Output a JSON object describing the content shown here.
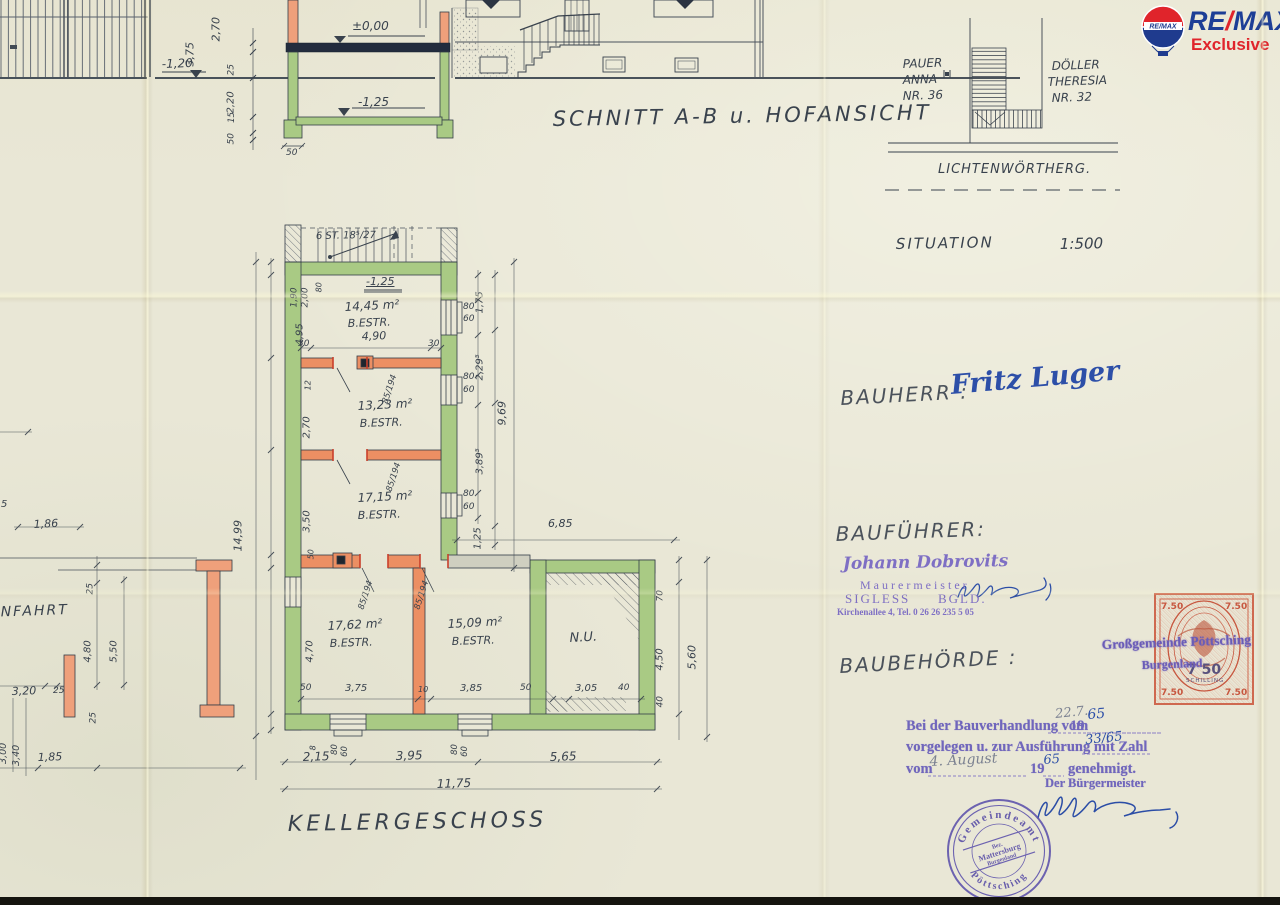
{
  "remax": {
    "re": "RE",
    "slash": "/",
    "max": "MAX",
    "sub": "Exclusive",
    "balloon_label": "RE/MAX",
    "blue": "#1d3e96",
    "red": "#e0242b"
  },
  "revenue_stamp": {
    "value": "7.50",
    "value_center": "7 50",
    "currency": "SCHILLING"
  },
  "round_stamp": {
    "top": "Gemeindeamt",
    "bottom": "Pöttsching",
    "mid1": "Bez.",
    "mid2": "Mattersburg",
    "mid3": "Burgenland"
  },
  "annotations": [
    {
      "n": "dim",
      "t": "3,75",
      "x": 196,
      "y": 55,
      "s": 11,
      "r": -90
    },
    {
      "n": "dim",
      "t": "2,70",
      "x": 222,
      "y": 30,
      "s": 11,
      "r": -90
    },
    {
      "n": "level",
      "t": "-1,20",
      "x": 162,
      "y": 58,
      "s": 12,
      "r": -2
    },
    {
      "n": "dim",
      "t": "25",
      "x": 237,
      "y": 66,
      "s": 9,
      "r": -90
    },
    {
      "n": "dim",
      "t": "2,20",
      "x": 237,
      "y": 103,
      "s": 10,
      "r": -90
    },
    {
      "n": "dim",
      "t": "15",
      "x": 237,
      "y": 114,
      "s": 8.5,
      "r": -90
    },
    {
      "n": "dim",
      "t": "50",
      "x": 237,
      "y": 135,
      "s": 9,
      "r": -90
    },
    {
      "n": "level",
      "t": "±0,00",
      "x": 352,
      "y": 20,
      "s": 12
    },
    {
      "n": "level",
      "t": "-1,25",
      "x": 358,
      "y": 96,
      "s": 12
    },
    {
      "n": "dim",
      "t": "50",
      "x": 286,
      "y": 149,
      "s": 9
    },
    {
      "n": "dim",
      "t": "85",
      "x": 1,
      "y": 70,
      "s": 8,
      "r": -90
    },
    {
      "n": "dim",
      "t": "15",
      "x": 1,
      "y": 82,
      "s": 8,
      "r": -90
    },
    {
      "n": "dim",
      "t": "2,40",
      "x": 1,
      "y": 112,
      "s": 8,
      "r": -90
    },
    {
      "n": "dim",
      "t": "25",
      "x": 1,
      "y": 138,
      "s": 8,
      "r": -90
    },
    {
      "n": "section-title",
      "t": "SCHNITT A-B u. HOFANSICHT",
      "x": 553,
      "y": 108,
      "s": 21,
      "r": -1,
      "ls": 3
    },
    {
      "n": "neighbor-name",
      "t": "PAUER",
      "x": 903,
      "y": 58,
      "s": 12,
      "r": -2
    },
    {
      "n": "neighbor-name",
      "t": "ANNA",
      "x": 903,
      "y": 74,
      "s": 12,
      "r": -2
    },
    {
      "n": "neighbor-name",
      "t": "NR. 36",
      "x": 903,
      "y": 90,
      "s": 12,
      "r": -2
    },
    {
      "n": "neighbor-name",
      "t": "DÖLLER",
      "x": 1052,
      "y": 60,
      "s": 12,
      "r": -2
    },
    {
      "n": "neighbor-name",
      "t": "THERESIA",
      "x": 1048,
      "y": 76,
      "s": 12,
      "r": -2
    },
    {
      "n": "neighbor-name",
      "t": "NR. 32",
      "x": 1052,
      "y": 92,
      "s": 12,
      "r": -2
    },
    {
      "n": "street-name",
      "t": "LICHTENWÖRTHERG.",
      "x": 938,
      "y": 163,
      "s": 13,
      "ls": 1
    },
    {
      "n": "situation-title",
      "t": "SITUATION",
      "x": 896,
      "y": 237,
      "s": 15,
      "ls": 2,
      "r": -1
    },
    {
      "n": "situation-scale",
      "t": "1:500",
      "x": 1060,
      "y": 237,
      "s": 15,
      "r": -1
    },
    {
      "n": "stair-note",
      "t": "6 ST. 18⁵/27",
      "x": 316,
      "y": 232,
      "s": 10,
      "r": -1
    },
    {
      "n": "level",
      "t": "-1,25",
      "x": 366,
      "y": 276,
      "s": 11,
      "u": 1
    },
    {
      "n": "room-area",
      "t": "14,45 m²",
      "x": 345,
      "y": 301,
      "s": 12,
      "r": -3
    },
    {
      "n": "room-type",
      "t": "B.ESTR.",
      "x": 348,
      "y": 318,
      "s": 11,
      "r": -2
    },
    {
      "n": "dim",
      "t": "4,90",
      "x": 362,
      "y": 331,
      "s": 11,
      "r": -2
    },
    {
      "n": "dim",
      "t": "30",
      "x": 298,
      "y": 340,
      "s": 9
    },
    {
      "n": "dim",
      "t": "30",
      "x": 428,
      "y": 340,
      "s": 9
    },
    {
      "n": "dim",
      "t": "1,90",
      "x": 300,
      "y": 298,
      "s": 9,
      "r": -90
    },
    {
      "n": "dim",
      "t": "2,00",
      "x": 311,
      "y": 298,
      "s": 9,
      "r": -90
    },
    {
      "n": "dim",
      "t": "80",
      "x": 324,
      "y": 284,
      "s": 8,
      "r": -90
    },
    {
      "n": "dim",
      "t": "4,95",
      "x": 306,
      "y": 335,
      "s": 10,
      "r": -90
    },
    {
      "n": "dim",
      "t": "12",
      "x": 313,
      "y": 382,
      "s": 8,
      "r": -90
    },
    {
      "n": "dim",
      "t": "2,70",
      "x": 313,
      "y": 428,
      "s": 10,
      "r": -90
    },
    {
      "n": "dim",
      "t": "3,50",
      "x": 313,
      "y": 522,
      "s": 10,
      "r": -90
    },
    {
      "n": "dim",
      "t": "50",
      "x": 316,
      "y": 551,
      "s": 8,
      "r": -90
    },
    {
      "n": "dim",
      "t": "4,70",
      "x": 316,
      "y": 652,
      "s": 10,
      "r": -90
    },
    {
      "n": "room-area",
      "t": "13,23 m²",
      "x": 358,
      "y": 400,
      "s": 12,
      "r": -3
    },
    {
      "n": "room-type",
      "t": "B.ESTR.",
      "x": 360,
      "y": 418,
      "s": 11,
      "r": -2
    },
    {
      "n": "room-area",
      "t": "17,15 m²",
      "x": 358,
      "y": 492,
      "s": 12,
      "r": -3
    },
    {
      "n": "room-type",
      "t": "B.ESTR.",
      "x": 358,
      "y": 510,
      "s": 11,
      "r": -2
    },
    {
      "n": "room-area",
      "t": "17,62 m²",
      "x": 328,
      "y": 620,
      "s": 12,
      "r": -3
    },
    {
      "n": "room-type",
      "t": "B.ESTR.",
      "x": 330,
      "y": 638,
      "s": 11,
      "r": -2
    },
    {
      "n": "room-area",
      "t": "15,09 m²",
      "x": 448,
      "y": 618,
      "s": 12,
      "r": -3
    },
    {
      "n": "room-type",
      "t": "B.ESTR.",
      "x": 452,
      "y": 636,
      "s": 11,
      "r": -2
    },
    {
      "n": "room-name",
      "t": "N.U.",
      "x": 570,
      "y": 632,
      "s": 13,
      "r": -3
    },
    {
      "n": "door-dim",
      "t": "85/194",
      "x": 390,
      "y": 396,
      "s": 8.5,
      "r": -72
    },
    {
      "n": "door-dim",
      "t": "85/194",
      "x": 394,
      "y": 484,
      "s": 8.5,
      "r": -72
    },
    {
      "n": "door-dim",
      "t": "85/194",
      "x": 366,
      "y": 602,
      "s": 8.5,
      "r": -72
    },
    {
      "n": "door-dim",
      "t": "85/194",
      "x": 422,
      "y": 602,
      "s": 8.5,
      "r": -72
    },
    {
      "n": "window-dim",
      "t": "80",
      "x": 463,
      "y": 303,
      "s": 9
    },
    {
      "n": "window-dim",
      "t": "60",
      "x": 463,
      "y": 315,
      "s": 9
    },
    {
      "n": "window-dim",
      "t": "80",
      "x": 463,
      "y": 373,
      "s": 9
    },
    {
      "n": "window-dim",
      "t": "60",
      "x": 463,
      "y": 386,
      "s": 9
    },
    {
      "n": "window-dim",
      "t": "80",
      "x": 463,
      "y": 490,
      "s": 9
    },
    {
      "n": "window-dim",
      "t": "60",
      "x": 463,
      "y": 503,
      "s": 9
    },
    {
      "n": "dim",
      "t": "1,75",
      "x": 486,
      "y": 303,
      "s": 10,
      "r": -90
    },
    {
      "n": "dim",
      "t": "2,29⁵",
      "x": 486,
      "y": 370,
      "s": 10,
      "r": -90
    },
    {
      "n": "dim",
      "t": "9,69",
      "x": 508,
      "y": 414,
      "s": 11,
      "r": -90
    },
    {
      "n": "dim",
      "t": "3,89⁵",
      "x": 486,
      "y": 464,
      "s": 10,
      "r": -90
    },
    {
      "n": "dim",
      "t": "1,25",
      "x": 484,
      "y": 539,
      "s": 10,
      "r": -90
    },
    {
      "n": "dim",
      "t": "6,85",
      "x": 548,
      "y": 518,
      "s": 11
    },
    {
      "n": "dim",
      "t": "70",
      "x": 666,
      "y": 592,
      "s": 9,
      "r": -90
    },
    {
      "n": "dim",
      "t": "4,50",
      "x": 666,
      "y": 660,
      "s": 10,
      "r": -90
    },
    {
      "n": "dim",
      "t": "40",
      "x": 666,
      "y": 698,
      "s": 9,
      "r": -90
    },
    {
      "n": "dim",
      "t": "5,60",
      "x": 698,
      "y": 658,
      "s": 11,
      "r": -90
    },
    {
      "n": "dim",
      "t": "3,05",
      "x": 575,
      "y": 684,
      "s": 10
    },
    {
      "n": "dim",
      "t": "40",
      "x": 618,
      "y": 684,
      "s": 9
    },
    {
      "n": "dim",
      "t": "50",
      "x": 520,
      "y": 684,
      "s": 9
    },
    {
      "n": "dim",
      "t": "50",
      "x": 300,
      "y": 684,
      "s": 9
    },
    {
      "n": "dim",
      "t": "3,75",
      "x": 345,
      "y": 684,
      "s": 10
    },
    {
      "n": "dim",
      "t": "10",
      "x": 418,
      "y": 686,
      "s": 8
    },
    {
      "n": "dim",
      "t": "3,85",
      "x": 460,
      "y": 684,
      "s": 10
    },
    {
      "n": "dim",
      "t": "8",
      "x": 318,
      "y": 742,
      "s": 8,
      "r": -90
    },
    {
      "n": "dim",
      "t": "80",
      "x": 340,
      "y": 746,
      "s": 8.5,
      "r": -90
    },
    {
      "n": "dim",
      "t": "60",
      "x": 350,
      "y": 748,
      "s": 8.5,
      "r": -90
    },
    {
      "n": "dim",
      "t": "80",
      "x": 460,
      "y": 746,
      "s": 8.5,
      "r": -90
    },
    {
      "n": "dim",
      "t": "60",
      "x": 470,
      "y": 748,
      "s": 8.5,
      "r": -90
    },
    {
      "n": "dim",
      "t": "2,15",
      "x": 303,
      "y": 751,
      "s": 12,
      "r": -2
    },
    {
      "n": "dim",
      "t": "3,95",
      "x": 396,
      "y": 750,
      "s": 12,
      "r": -2
    },
    {
      "n": "dim",
      "t": "5,65",
      "x": 550,
      "y": 751,
      "s": 12,
      "r": -2
    },
    {
      "n": "dim",
      "t": "11,75",
      "x": 437,
      "y": 778,
      "s": 12,
      "r": -2
    },
    {
      "n": "plan-title",
      "t": "KELLERGESCHOSS",
      "x": 288,
      "y": 813,
      "s": 22,
      "ls": 4,
      "r": -1
    },
    {
      "n": "dim",
      "t": "14,99",
      "x": 244,
      "y": 540,
      "s": 11,
      "r": -90
    },
    {
      "n": "dim",
      "t": "1,86",
      "x": 34,
      "y": 519,
      "s": 11,
      "r": -3
    },
    {
      "n": "dim",
      "t": "25",
      "x": 96,
      "y": 585,
      "s": 9,
      "r": -90
    },
    {
      "n": "dim",
      "t": "4,80",
      "x": 94,
      "y": 652,
      "s": 10,
      "r": -90
    },
    {
      "n": "dim",
      "t": "5,50",
      "x": 120,
      "y": 652,
      "s": 10,
      "r": -90
    },
    {
      "n": "dim",
      "t": "3,20",
      "x": 12,
      "y": 686,
      "s": 11,
      "r": -2
    },
    {
      "n": "dim",
      "t": "25",
      "x": 53,
      "y": 687,
      "s": 9
    },
    {
      "n": "dim",
      "t": "25",
      "x": 99,
      "y": 714,
      "s": 9,
      "r": -90
    },
    {
      "n": "dim",
      "t": "3,00",
      "x": 9,
      "y": 754,
      "s": 9.5,
      "r": -90
    },
    {
      "n": "dim",
      "t": "3,40",
      "x": 22,
      "y": 756,
      "s": 9.5,
      "r": -90
    },
    {
      "n": "dim",
      "t": "1,85",
      "x": 38,
      "y": 752,
      "s": 11,
      "r": -2
    },
    {
      "n": "room-name",
      "t": "EINFAHRT",
      "x": -16,
      "y": 606,
      "s": 14,
      "ls": 2,
      "r": -2
    },
    {
      "n": "dim",
      "t": "5",
      "x": 1,
      "y": 500,
      "s": 10
    },
    {
      "n": "field-label",
      "t": "BAUHERR :",
      "x": 841,
      "y": 388,
      "s": 20,
      "ls": 2,
      "r": -3,
      "c": "pencil"
    },
    {
      "n": "bauherr-name",
      "t": "Fritz Luger",
      "x": 952,
      "y": 372,
      "s": 27,
      "r": -5,
      "c": "blue",
      "f": "hand",
      "w": "bold"
    },
    {
      "n": "field-label",
      "t": "BAUFÜHRER:",
      "x": 836,
      "y": 524,
      "s": 20,
      "ls": 2,
      "r": -2,
      "c": "pencil"
    },
    {
      "n": "stamp-line",
      "t": "Johann Dobrovits",
      "x": 843,
      "y": 556,
      "s": 17,
      "r": -1,
      "c": "stamp",
      "f": "hand",
      "w": "bold"
    },
    {
      "n": "stamp-line",
      "t": "Maurermeister",
      "x": 860,
      "y": 579,
      "s": 12,
      "ls": 3,
      "c": "stamp"
    },
    {
      "n": "stamp-line",
      "t": "SIGLESS",
      "x": 845,
      "y": 592,
      "s": 13,
      "ls": 2,
      "c": "stamp"
    },
    {
      "n": "stamp-line",
      "t": "BGLD.",
      "x": 938,
      "y": 592,
      "s": 13,
      "ls": 2,
      "c": "stamp"
    },
    {
      "n": "stamp-line",
      "t": "Kirchenallee 4,   Tel. 0 26 26 235 5 05",
      "x": 837,
      "y": 608,
      "s": 9,
      "w": "bold",
      "c": "stamp"
    },
    {
      "n": "field-label",
      "t": "BAUBEHÖRDE :",
      "x": 840,
      "y": 656,
      "s": 20,
      "ls": 2,
      "r": -3,
      "c": "pencil"
    },
    {
      "n": "overprint",
      "t": "Großgemeinde Pöttsching",
      "x": 1102,
      "y": 638,
      "s": 13.5,
      "w": "bold",
      "r": -2,
      "c": "stampB"
    },
    {
      "n": "overprint",
      "t": "Burgenland",
      "x": 1142,
      "y": 659,
      "s": 12,
      "w": "bold",
      "r": -2,
      "c": "stampB"
    },
    {
      "n": "form-line",
      "t": "Bei der Bauverhandlung vom",
      "x": 906,
      "y": 719,
      "s": 14.5,
      "w": "bold",
      "c": "form"
    },
    {
      "n": "form-line",
      "t": "19",
      "x": 1070,
      "y": 719,
      "s": 14.5,
      "w": "bold",
      "c": "form"
    },
    {
      "n": "form-line",
      "t": "vorgelegen u. zur Ausführung mit Zahl",
      "x": 906,
      "y": 740,
      "s": 14.5,
      "w": "bold",
      "c": "form"
    },
    {
      "n": "form-line",
      "t": "vom",
      "x": 906,
      "y": 762,
      "s": 14.5,
      "w": "bold",
      "c": "form"
    },
    {
      "n": "form-line",
      "t": "19",
      "x": 1030,
      "y": 762,
      "s": 14.5,
      "w": "bold",
      "c": "form"
    },
    {
      "n": "form-line",
      "t": "genehmigt.",
      "x": 1068,
      "y": 762,
      "s": 14.5,
      "w": "bold",
      "c": "form"
    },
    {
      "n": "form-line",
      "t": "Der Bürgermeister",
      "x": 1045,
      "y": 777,
      "s": 12.5,
      "w": "bold",
      "c": "form"
    },
    {
      "n": "handwriting",
      "t": "22.7.",
      "x": 1056,
      "y": 708,
      "s": 13,
      "r": -6,
      "c": "gray",
      "f": "hand"
    },
    {
      "n": "handwriting",
      "t": "65",
      "x": 1088,
      "y": 708,
      "s": 14,
      "r": -4,
      "c": "blue",
      "f": "hand"
    },
    {
      "n": "handwriting",
      "t": "33/65",
      "x": 1086,
      "y": 734,
      "s": 13,
      "r": -6,
      "c": "blue",
      "f": "hand"
    },
    {
      "n": "handwriting",
      "t": "4. August",
      "x": 930,
      "y": 755,
      "s": 14,
      "r": -3,
      "c": "gray",
      "f": "hand"
    },
    {
      "n": "handwriting",
      "t": "65",
      "x": 1044,
      "y": 754,
      "s": 13,
      "r": -4,
      "c": "blue",
      "f": "hand"
    }
  ]
}
